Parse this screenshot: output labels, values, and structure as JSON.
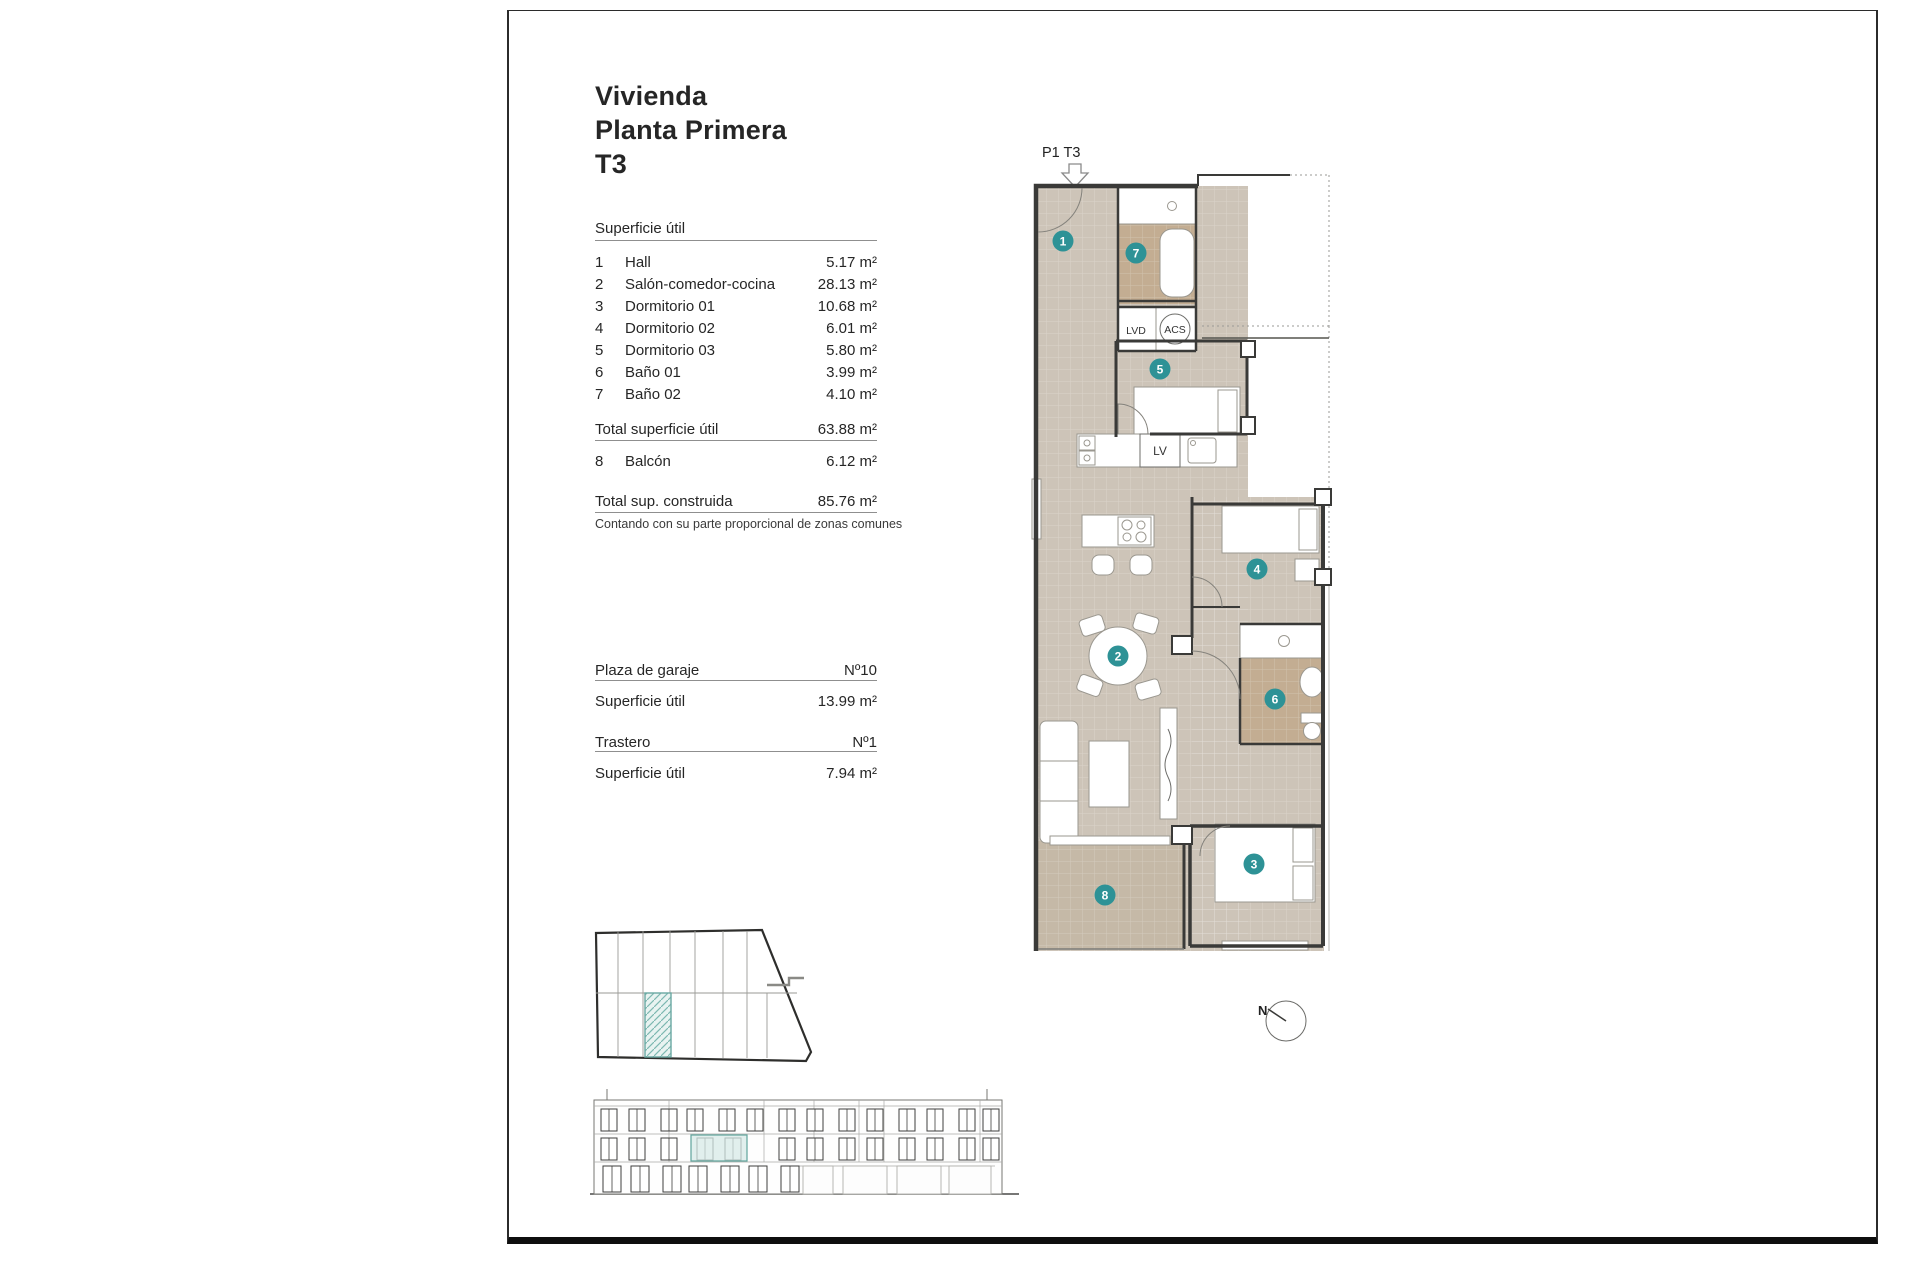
{
  "document": {
    "title_lines": [
      "Vivienda",
      "Planta Primera",
      "T3"
    ]
  },
  "area_table": {
    "header": "Superficie útil",
    "rows": [
      {
        "num": "1",
        "label": "Hall",
        "value": "5.17 m²"
      },
      {
        "num": "2",
        "label": "Salón-comedor-cocina",
        "value": "28.13 m²"
      },
      {
        "num": "3",
        "label": "Dormitorio 01",
        "value": "10.68 m²"
      },
      {
        "num": "4",
        "label": "Dormitorio 02",
        "value": "6.01 m²"
      },
      {
        "num": "5",
        "label": "Dormitorio 03",
        "value": "5.80 m²"
      },
      {
        "num": "6",
        "label": "Baño 01",
        "value": "3.99 m²"
      },
      {
        "num": "7",
        "label": "Baño 02",
        "value": "4.10 m²"
      }
    ],
    "total_label": "Total superficie útil",
    "total_value": "63.88 m²",
    "balcony": {
      "num": "8",
      "label": "Balcón",
      "value": "6.12 m²"
    },
    "built_label": "Total sup. construida",
    "built_value": "85.76 m²",
    "footnote": "Contando con su parte proporcional de zonas comunes"
  },
  "annexes": {
    "garage_label": "Plaza de garaje",
    "garage_number": "Nº10",
    "garage_area_label": "Superficie útil",
    "garage_area_value": "13.99 m²",
    "storage_label": "Trastero",
    "storage_number": "Nº1",
    "storage_area_label": "Superficie útil",
    "storage_area_value": "7.94 m²"
  },
  "floor_plan": {
    "unit_tag": "P1 T3",
    "markers": {
      "hall": "1",
      "living": "2",
      "bed1": "3",
      "bed2": "4",
      "bed3": "5",
      "bath1": "6",
      "bath2": "7",
      "balcony": "8"
    },
    "labels": {
      "washer": "LVD",
      "water_heater": "ACS",
      "dishwasher": "LV"
    },
    "compass_label": "N"
  },
  "colors": {
    "floor": "#cdc4b8",
    "wet_floor": "#c3ad92",
    "balcony_floor": "#c5b9a7",
    "marker": "#2e9296",
    "wall": "#3a3a38",
    "highlight_fill": "#d7eae7",
    "highlight_stroke": "#5fa39c"
  }
}
